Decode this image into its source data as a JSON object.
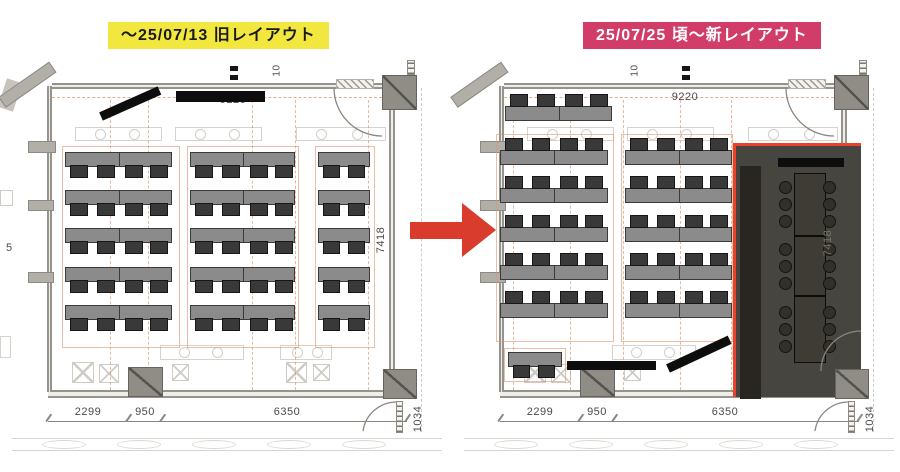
{
  "labels": {
    "old": {
      "text": "〜25/07/13 旧レイアウト",
      "bg": "#f2e73e",
      "fg": "#191919"
    },
    "new": {
      "text": "25/07/25 頃〜新レイアウト",
      "bg": "#d23c68",
      "fg": "#ffffff"
    }
  },
  "arrow": {
    "direction": "right",
    "color": "#d93b2c"
  },
  "left_plan": {
    "dims": {
      "top": "9220",
      "side": "7418",
      "bottom": [
        "2299",
        "950",
        "6350"
      ],
      "door": "1034",
      "clipped_top": "10"
    },
    "desks": {
      "rows": 5,
      "row_pattern": [
        "double-4chairs",
        "double-4chairs",
        "single-2chairs"
      ],
      "chairs_side": "bottom"
    },
    "redaction_bars": 2
  },
  "right_plan": {
    "dims": {
      "top": "9220",
      "side": "7418",
      "bottom": [
        "2299",
        "950",
        "6350"
      ],
      "door": "1034",
      "clipped_top": "10"
    },
    "desks": {
      "rows": 5,
      "row_pattern": [
        "double-4chairs",
        "double-4chairs"
      ],
      "chairs_side": "top",
      "top_row_extra_group": true,
      "small_desk": {
        "chairs": 2
      }
    },
    "meeting_room": {
      "fill": "#47453f",
      "accent": "#e8432a",
      "cabinet": "#2a2620",
      "table_segments": 3,
      "chairs_per_side": 9
    },
    "redaction_bars": 3
  },
  "edge": {
    "left_clipped_dim": "5"
  },
  "palette": {
    "table": "#8b8b8b",
    "chair": "#3a3a3a",
    "wall": "#b2afa9",
    "column": "#8f8c86",
    "centerline": "#de9169",
    "linework": "#d6d3cd",
    "redaction": "#111111"
  }
}
